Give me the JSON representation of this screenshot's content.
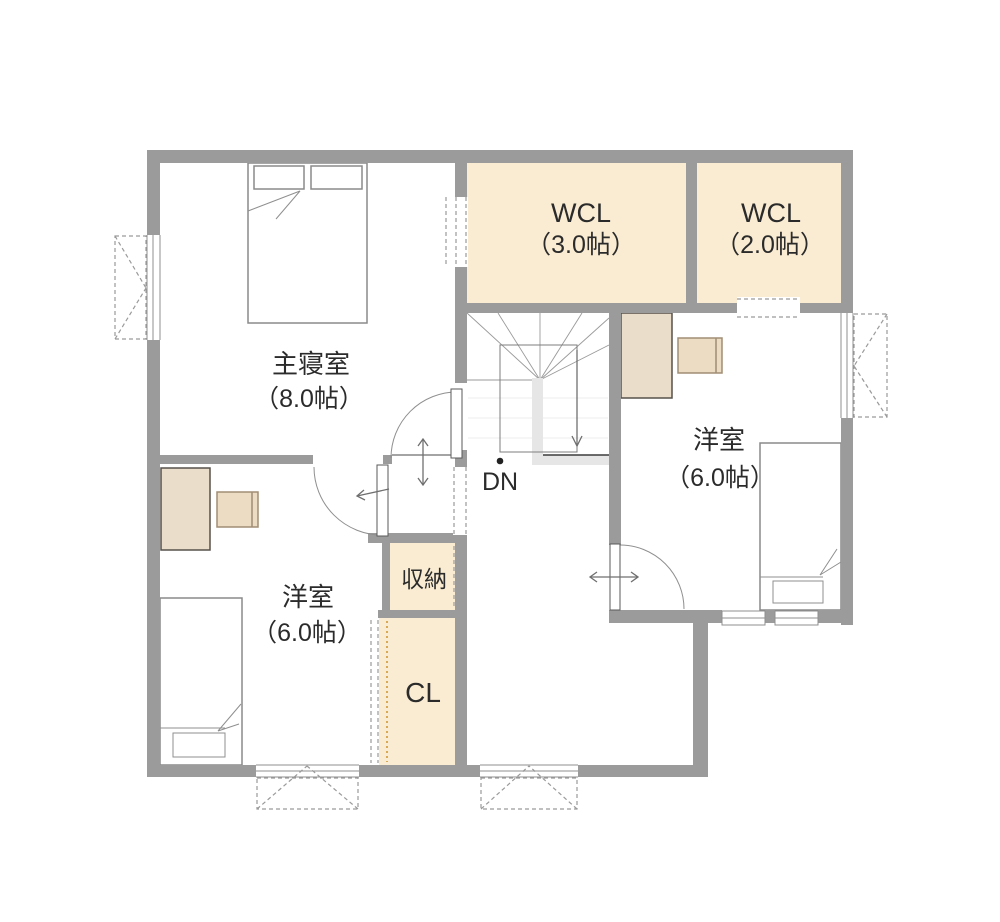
{
  "title": "2F floor plan",
  "colors": {
    "wall": "#9b9b9b",
    "closet_fill": "#faecd2",
    "desk_fill": "#eaddca",
    "chair_fill": "#ecdcc3",
    "bed_fill": "#ffffff",
    "background": "#ffffff",
    "text": "#2b2b2b",
    "closet_rail": "#d9a855"
  },
  "floorplan": {
    "rooms": [
      {
        "name": "master-bedroom",
        "label": "主寝室",
        "size": "（8.0帖）"
      },
      {
        "name": "wcl-3",
        "label": "WCL",
        "size": "（3.0帖）"
      },
      {
        "name": "wcl-2",
        "label": "WCL",
        "size": "（2.0帖）"
      },
      {
        "name": "western-room-right",
        "label": "洋室",
        "size": "（6.0帖）"
      },
      {
        "name": "western-room-left",
        "label": "洋室",
        "size": "（6.0帖）"
      },
      {
        "name": "storage",
        "label": "収納"
      },
      {
        "name": "closet",
        "label": "CL"
      }
    ],
    "stairs": {
      "down_label": "DN"
    },
    "furniture": [
      "double-bed",
      "single-bed",
      "single-bed",
      "desk",
      "chair",
      "desk",
      "chair"
    ],
    "features": [
      "casement-window-left",
      "casement-window-right",
      "casement-window-bottom-1",
      "casement-window-bottom-2",
      "slider-window-1",
      "slider-window-2"
    ]
  }
}
